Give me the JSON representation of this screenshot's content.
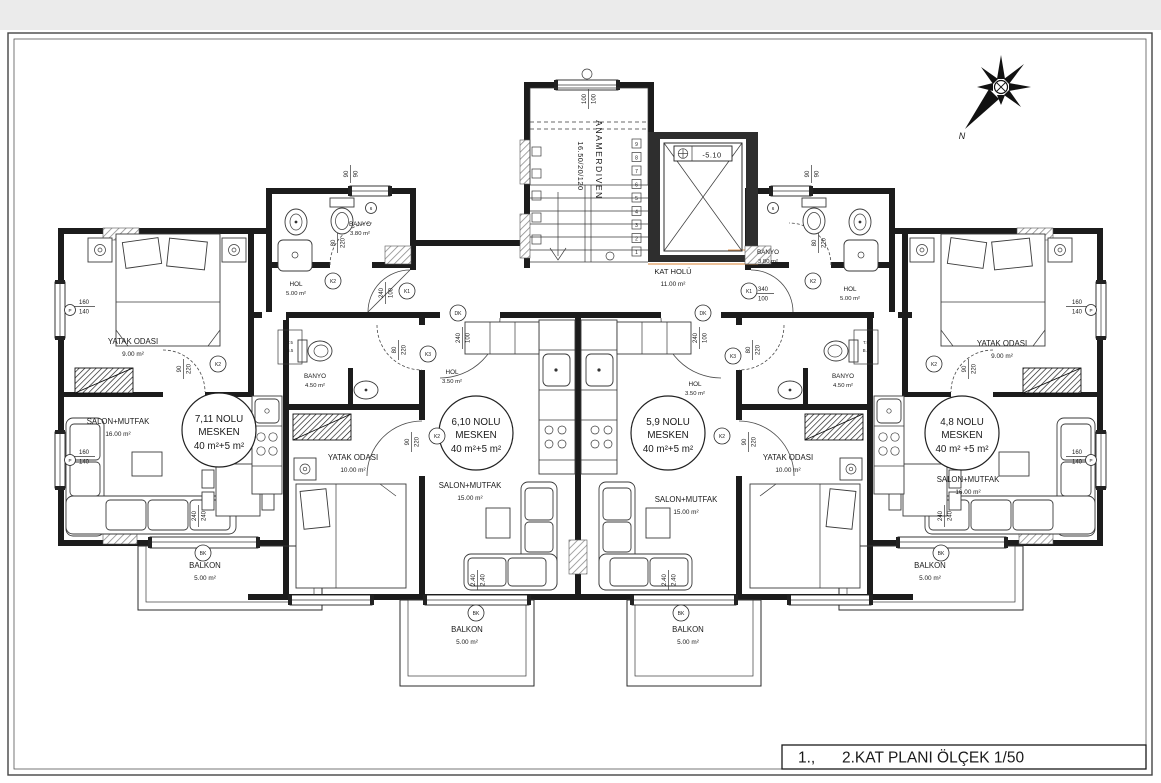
{
  "title_block": {
    "prefix": "1.,",
    "label": "2.KAT PLANI ÖLÇEK 1/50"
  },
  "compass": {
    "north": "N"
  },
  "core": {
    "stair_name": "ANAMERDIVEN",
    "stair_dim": "16.50/20/120",
    "elevator_level": "-5.10",
    "hall_name": "KAT HOLÜ",
    "hall_area": "11.00 m²",
    "steps": [
      "1",
      "2",
      "3",
      "4",
      "5",
      "6",
      "7",
      "8",
      "9"
    ]
  },
  "units": [
    {
      "name_line": "7,11 NOLU",
      "type_line": "MESKEN",
      "area_line": "40 m²+5 m²"
    },
    {
      "name_line": "6,10 NOLU",
      "type_line": "MESKEN",
      "area_line": "40 m²+5 m²"
    },
    {
      "name_line": "5,9 NOLU",
      "type_line": "MESKEN",
      "area_line": "40 m²+5 m²"
    },
    {
      "name_line": "4,8 NOLU",
      "type_line": "MESKEN",
      "area_line": "40 m² +5 m²"
    }
  ],
  "rooms": [
    {
      "name": "HOL",
      "area": "5.00 m²"
    },
    {
      "name": "BANYO",
      "area": "3.80 m²"
    },
    {
      "name": "YATAK ODASI",
      "area": "9.00 m²"
    },
    {
      "name": "SALON+MUTFAK",
      "area": "16.00 m²"
    },
    {
      "name": "BALKON",
      "area": "5.00 m²"
    },
    {
      "name": "BANYO",
      "area": "4.50 m²"
    },
    {
      "name": "HOL",
      "area": "3.50 m²"
    },
    {
      "name": "YATAK ODASI",
      "area": "10.00 m²"
    },
    {
      "name": "SALON+MUTFAK",
      "area": "15.00 m²"
    },
    {
      "name": "BALKON",
      "area": "5.00 m²"
    },
    {
      "name": "HOL",
      "area": "3.50 m²"
    },
    {
      "name": "BANYO",
      "area": "4.50 m²"
    },
    {
      "name": "YATAK ODASI",
      "area": "10.00 m²"
    },
    {
      "name": "SALON+MUTFAK",
      "area": "15.00 m²"
    },
    {
      "name": "BALKON",
      "area": "5.00 m²"
    },
    {
      "name": "BANYO",
      "area": "3.80 m²"
    },
    {
      "name": "HOL",
      "area": "5.00 m²"
    },
    {
      "name": "YATAK ODASI",
      "area": "9.00 m²"
    },
    {
      "name": "SALON+MUTFAK",
      "area": "16.00 m²"
    },
    {
      "name": "BALKON",
      "area": "5.00 m²"
    },
    {
      "name": "KAT HOLÜ",
      "area": "11.00 m²"
    }
  ],
  "dims": [
    {
      "t": "160",
      "b": "140"
    },
    {
      "t": "160",
      "b": "140"
    },
    {
      "t": "160",
      "b": "140"
    },
    {
      "t": "160",
      "b": "140"
    },
    {
      "t": "90",
      "b": "90"
    },
    {
      "t": "90",
      "b": "90"
    },
    {
      "t": "100",
      "b": "100"
    },
    {
      "t": "90",
      "b": "220"
    },
    {
      "t": "90",
      "b": "220"
    },
    {
      "t": "80",
      "b": "220"
    },
    {
      "t": "80",
      "b": "220"
    },
    {
      "t": "240",
      "b": "100"
    },
    {
      "t": "340",
      "b": "100"
    },
    {
      "t": "80",
      "b": "220"
    },
    {
      "t": "80",
      "b": "220"
    },
    {
      "t": "90",
      "b": "220"
    },
    {
      "t": "90",
      "b": "220"
    },
    {
      "t": "240",
      "b": "240"
    },
    {
      "t": "240",
      "b": "240"
    },
    {
      "t": "2.40",
      "b": "2.40"
    },
    {
      "t": "2.40",
      "b": "2.40"
    },
    {
      "t": "240",
      "b": "100"
    },
    {
      "t": "240",
      "b": "100"
    }
  ],
  "tags": [
    {
      "label": "K1"
    },
    {
      "label": "K1"
    },
    {
      "label": "K2"
    },
    {
      "label": "K2"
    },
    {
      "label": "K2"
    },
    {
      "label": "K2"
    },
    {
      "label": "K2"
    },
    {
      "label": "K2"
    },
    {
      "label": "K3"
    },
    {
      "label": "K3"
    },
    {
      "label": "DK"
    },
    {
      "label": "DK"
    },
    {
      "label": "BK"
    },
    {
      "label": "BK"
    },
    {
      "label": "BK"
    },
    {
      "label": "BK"
    },
    {
      "label": "P"
    },
    {
      "label": "P"
    },
    {
      "label": "P"
    },
    {
      "label": "P"
    },
    {
      "label": "6"
    },
    {
      "label": "6"
    }
  ],
  "shafts": {
    "line1": "T.5",
    "line2": "B.5"
  }
}
